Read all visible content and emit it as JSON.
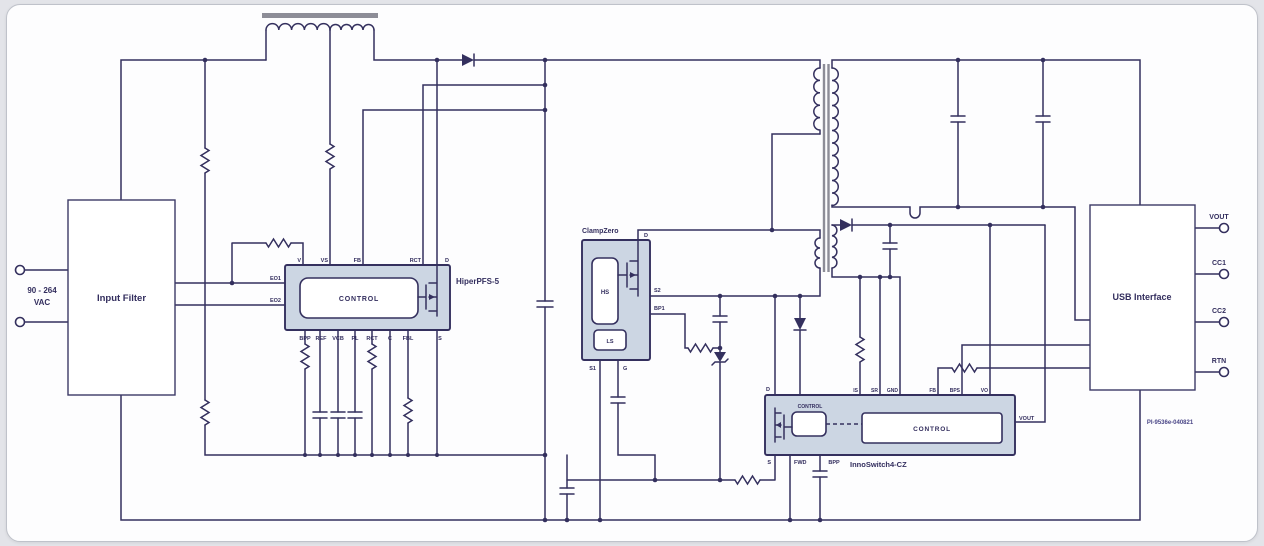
{
  "input": {
    "range": "90 - 264",
    "unit": "VAC",
    "filter_label": "Input Filter"
  },
  "pfs": {
    "name": "HiperPFS-5",
    "control": "CONTROL",
    "pins_top": [
      "V",
      "VS",
      "FB",
      "RCT",
      "D"
    ],
    "pins_left": [
      "EO1",
      "EO2"
    ],
    "pins_bottom": [
      "BPP",
      "REF",
      "VCB",
      "PL",
      "RCT",
      "C",
      "FBL",
      "S"
    ]
  },
  "clamp": {
    "name": "ClampZero",
    "hs": "HS",
    "ls": "LS",
    "pin_d": "D",
    "pins_right": [
      "S2",
      "BP1"
    ],
    "pins_bottom": [
      "S1",
      "G"
    ]
  },
  "inno": {
    "name": "InnoSwitch4-CZ",
    "control": "CONTROL",
    "control_primary": "CONTROL",
    "pin_d": "D",
    "pins_top": [
      "IS",
      "SR",
      "GND",
      "FB",
      "BPS",
      "VO"
    ],
    "pins_bottom": [
      "S",
      "FWD",
      "BPP"
    ],
    "pin_right": "VOUT"
  },
  "usb": {
    "label": "USB Interface",
    "terminals": [
      "VOUT",
      "CC1",
      "CC2",
      "RTN"
    ]
  },
  "footer": {
    "part_number": "PI-9536e-040821"
  },
  "colors": {
    "wire": "#34305e",
    "block_fill": "#ccd6e3",
    "core": "#8d8d97",
    "background": "#fdfdfe"
  }
}
